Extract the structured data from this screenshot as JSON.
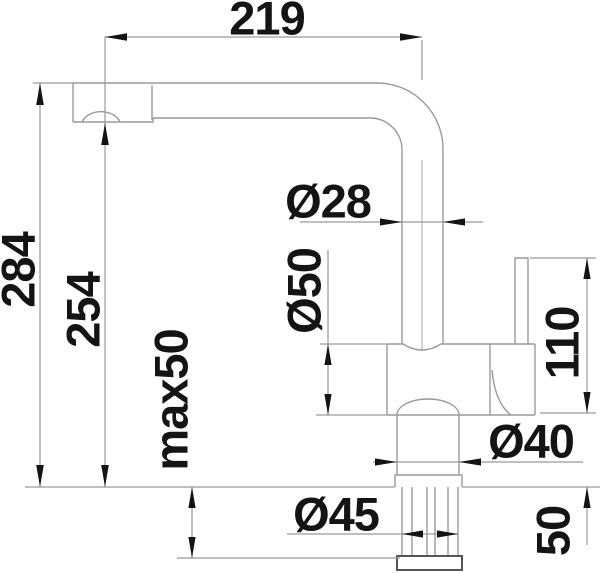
{
  "drawing": {
    "kind": "faucet-installation-dimension-drawing",
    "labels": {
      "spout_reach": "219",
      "overall_height": "284",
      "outlet_height": "254",
      "max_mounting_thickness": "max50",
      "spout_pipe_diameter": "Ø28",
      "body_diameter": "Ø50",
      "lever_height": "110",
      "base_diameter": "Ø40",
      "mounting_hole_diameter": "Ø45",
      "below_counter_clearance": "50"
    },
    "style": {
      "line_color": "#9a9a9a",
      "dark_line_color": "#555555",
      "text_color": "#141414",
      "background": "#ffffff"
    }
  }
}
